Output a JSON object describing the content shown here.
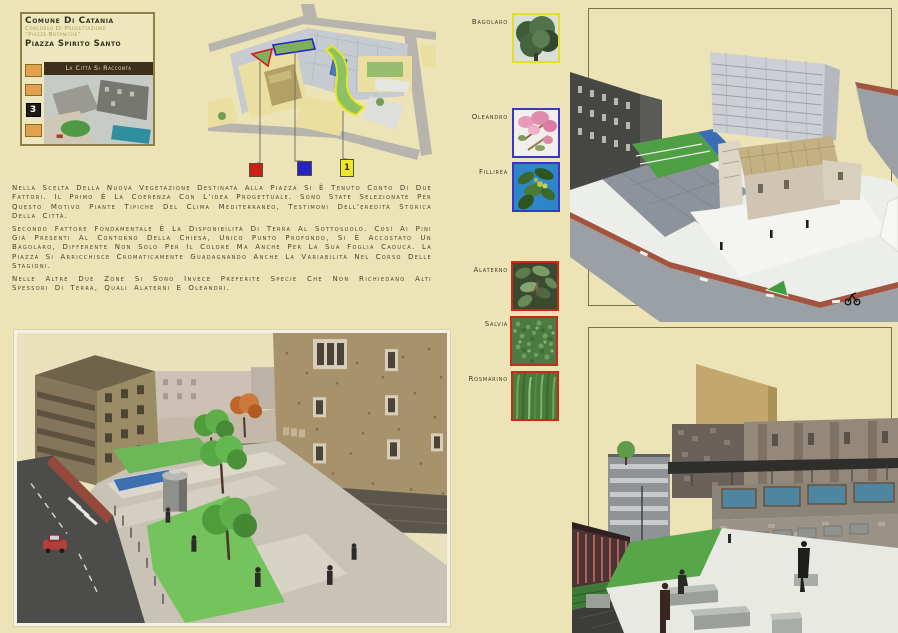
{
  "board": {
    "background": "#ece4b6"
  },
  "header": {
    "municipality": "Comune di Catania",
    "competition_line1": "Concorso di progettazione",
    "competition_line2": "“Piazze Botaniche”",
    "project_title": "Piazza Spirito Santo",
    "theme": "La città si racconta",
    "sheet_number": "3",
    "accent_orange": "#e2a14c",
    "banner_bg": "#3e2f1d"
  },
  "site_plan": {
    "legend": [
      {
        "zone": "piazza-zone-red",
        "color": "#c92118",
        "label": ""
      },
      {
        "zone": "piazza-zone-blue",
        "color": "#2524c0",
        "label": ""
      },
      {
        "zone": "piazza-zone-yellow",
        "color": "#efe92c",
        "label": "1"
      }
    ]
  },
  "description": {
    "paragraphs": [
      "Nella scelta della nuova vegetazione destinata alla piazza si è tenuto conto di due fattori. Il primo è la coerenza con l'idea progettuale. Sono state selezionate per questo motivo piante tipiche del clima mediterraneo, testimoni dell'eredità storica della città.",
      "Secondo fattore fondamentale è la disponibilità di terra al sottosuolo. Così ai pini già presenti al contorno della chiesa, unico punto profondo, si è accostato un bagolaro, differente non solo per il colore ma anche per la sua foglia caduca. La piazza si arricchisce cromaticamente guadagnando anche la variabilità nel corso delle stagioni.",
      "Nelle altre due zone si sono invece preferite specie che non richiedano alti spessori di terra, quali alaterni e oleandri."
    ]
  },
  "plants": {
    "items": [
      {
        "name": "Bagolaro",
        "border_color": "#e3df2e"
      },
      {
        "name": "Oleandro",
        "border_color": "#3936cd"
      },
      {
        "name": "Fillirea",
        "border_color": "#3936cd"
      },
      {
        "name": "Alaterno",
        "border_color": "#cd2817"
      },
      {
        "name": "Salvia",
        "border_color": "#cd2817"
      },
      {
        "name": "Rosmarino",
        "border_color": "#cd2817"
      }
    ]
  },
  "renderings": {
    "aerial": "aerial-view-of-piazza-spirito-santo",
    "eye_level": "eye-level-view-of-piazza",
    "elevated": "elevated-view-of-linear-piazza"
  }
}
